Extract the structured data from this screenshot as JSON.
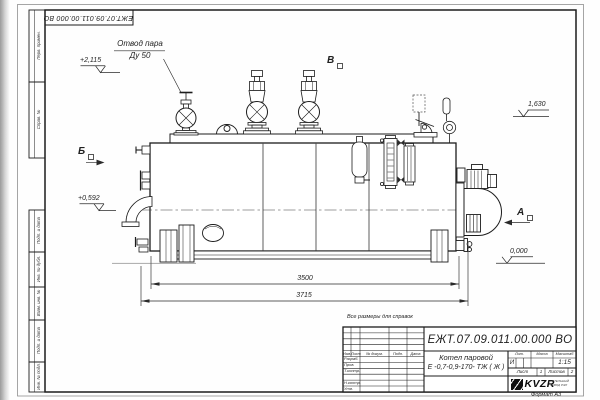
{
  "sheet": {
    "note": "Все размеры для справок",
    "format_note": "Формат А3"
  },
  "margin_labels": [
    "Перв. примен.",
    "Справ. №",
    "Подп. и дата",
    "Инв. № дубл.",
    "Взам. инв. №",
    "Подп. и дата",
    "Инв. № подл."
  ],
  "drawing": {
    "callout_line1": "Отвод пара",
    "callout_line2": "Ду 50",
    "levels": {
      "steam_valve_top": "+2,115",
      "shell_top": "1,630",
      "front_elbow": "+0,592",
      "ground": "0,000"
    },
    "dimensions": {
      "shell_length": "3500",
      "overall_length": "3715"
    },
    "views": {
      "left": "Б",
      "top": "В",
      "right": "А"
    }
  },
  "title_block": {
    "designation": "ЕЖТ.07.09.011.00.000  ВО",
    "product_name_line1": "Котел паровой",
    "product_name_line2": "Е -0,7-0,9-170- ТЖ ( Ж )",
    "header": {
      "izm": "Изм.",
      "list": "Лист",
      "doc": "№ докум.",
      "podp": "Подп.",
      "date": "Дата"
    },
    "rows": [
      "Разраб.",
      "Пров.",
      "Т.контр.",
      "Н.контр.",
      "Утв."
    ],
    "lit_label": "Лит.",
    "mass_label": "Масса",
    "scale_label": "Масштаб",
    "lit_value": "И",
    "scale_value": "1:15",
    "sheet_label": "Лист",
    "sheet_value": "1",
    "sheets_label": "Листов",
    "sheets_value": "2",
    "logo_word": "KVZR",
    "logo_sub1": "КОТЕЛЬНЫЙ",
    "logo_sub2": "ЗАВОД РЭП"
  }
}
